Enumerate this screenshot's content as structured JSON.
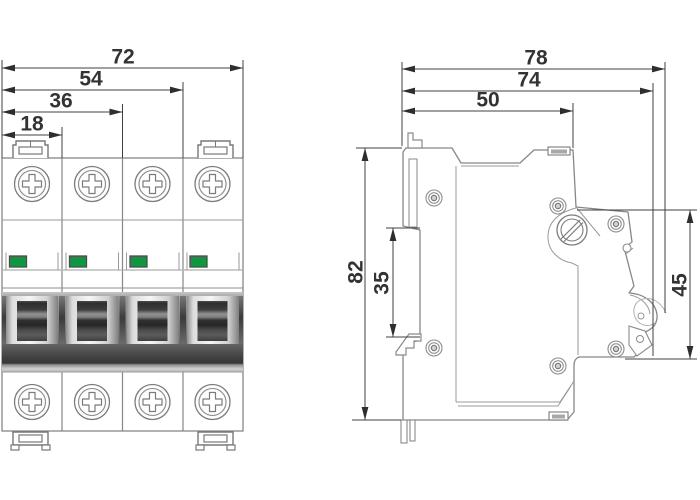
{
  "front_view": {
    "pole_count": 4,
    "width_dims": [
      "72",
      "54",
      "36",
      "18"
    ]
  },
  "side_view": {
    "depth_dims": [
      "78",
      "74",
      "50"
    ],
    "height_dims": [
      "82",
      "35",
      "45"
    ]
  },
  "colors": {
    "indicator_green": "#109540",
    "outline_gray": "#878787",
    "dim_color": "#3d3d3d"
  }
}
